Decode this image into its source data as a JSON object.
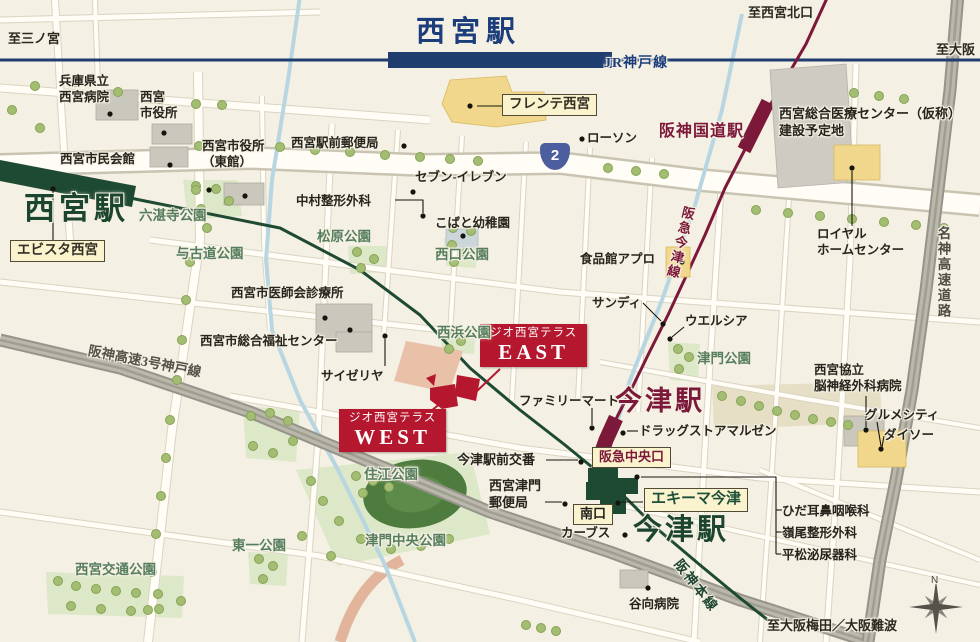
{
  "stations": {
    "jr_nishinomiya": "西宮駅",
    "hanshin_nishinomiya": "西宮駅",
    "hankyu_kokudo": "阪神国道駅",
    "hankyu_imazu": "今津駅",
    "hanshin_imazu": "今津駅"
  },
  "railways": {
    "jr_kobe_line": "JR神戸線",
    "hankyu_imazu_line": "阪急今津線",
    "hanshin_main_line": "阪神本線"
  },
  "roads": {
    "hanshin_expressway": "阪神高速3号神戸線",
    "meishin_expressway": "名神高速道路",
    "route2_number": "2"
  },
  "directions": {
    "to_sannomiya": "至三ノ宮",
    "to_osaka": "至大阪",
    "to_nishinomiya_kitaguchi": "至西宮北口",
    "to_osaka_umeda_namba": "至大阪梅田／大阪難波"
  },
  "property": {
    "brand": "ジオ西宮テラス",
    "east": "EAST",
    "west": "WEST"
  },
  "exits": {
    "hankyu_central": "阪急中央口",
    "south": "南口"
  },
  "commercial_labels": {
    "ebista": "エビスタ西宮",
    "frente": "フレンテ西宮",
    "ekima_imazu": "エキーマ今津"
  },
  "pois": {
    "hyogo_hospital": "兵庫県立\n西宮病院",
    "city_hall": "西宮\n市役所",
    "civic_hall": "西宮市民会館",
    "city_hall_east": "西宮市役所\n（東館）",
    "ekimae_post_office": "西宮駅前郵便局",
    "seven_eleven": "セブン-イレブン",
    "nakamura_seikei": "中村整形外科",
    "kobato_kindergarten": "こばと幼稚園",
    "lawson": "ローソン",
    "apro": "食品館アプロ",
    "sandy": "サンディ",
    "welcia": "ウエルシア",
    "medical_center_site": "西宮総合医療センター（仮称）\n建設予定地",
    "royal_home_center": "ロイヤル\nホームセンター",
    "kyoritsu_hospital": "西宮協立\n脳神経外科病院",
    "gourmet_city": "グルメシティ",
    "daiso": "ダイソー",
    "ishikai_clinic": "西宮市医師会診療所",
    "fukushi_center": "西宮市総合福祉センター",
    "saizeriya": "サイゼリヤ",
    "family_mart": "ファミリーマート",
    "imazu_koban": "今津駅前交番",
    "tsuto_post_office": "西宮津門\n郵便局",
    "curves": "カーブス",
    "drug_maruzen": "ドラッグストアマルゼン",
    "hida_ent": "ひだ耳鼻咽喉科",
    "mineo_seikei": "嶺尾整形外科",
    "hiramatsu_urology": "平松泌尿器科",
    "tanimukai_hospital": "谷向病院"
  },
  "parks": {
    "rokutanji": "六湛寺公園",
    "yokodo": "与古道公園",
    "matsubara": "松原公園",
    "nishiguchi": "西口公園",
    "nishihama": "西浜公園",
    "tsuto": "津門公園",
    "sumie": "住江公園",
    "tsuto_chuo": "津門中央公園",
    "higashiichi": "東一公園",
    "kotsu": "西宮交通公園"
  },
  "compass": {
    "north": "N"
  }
}
